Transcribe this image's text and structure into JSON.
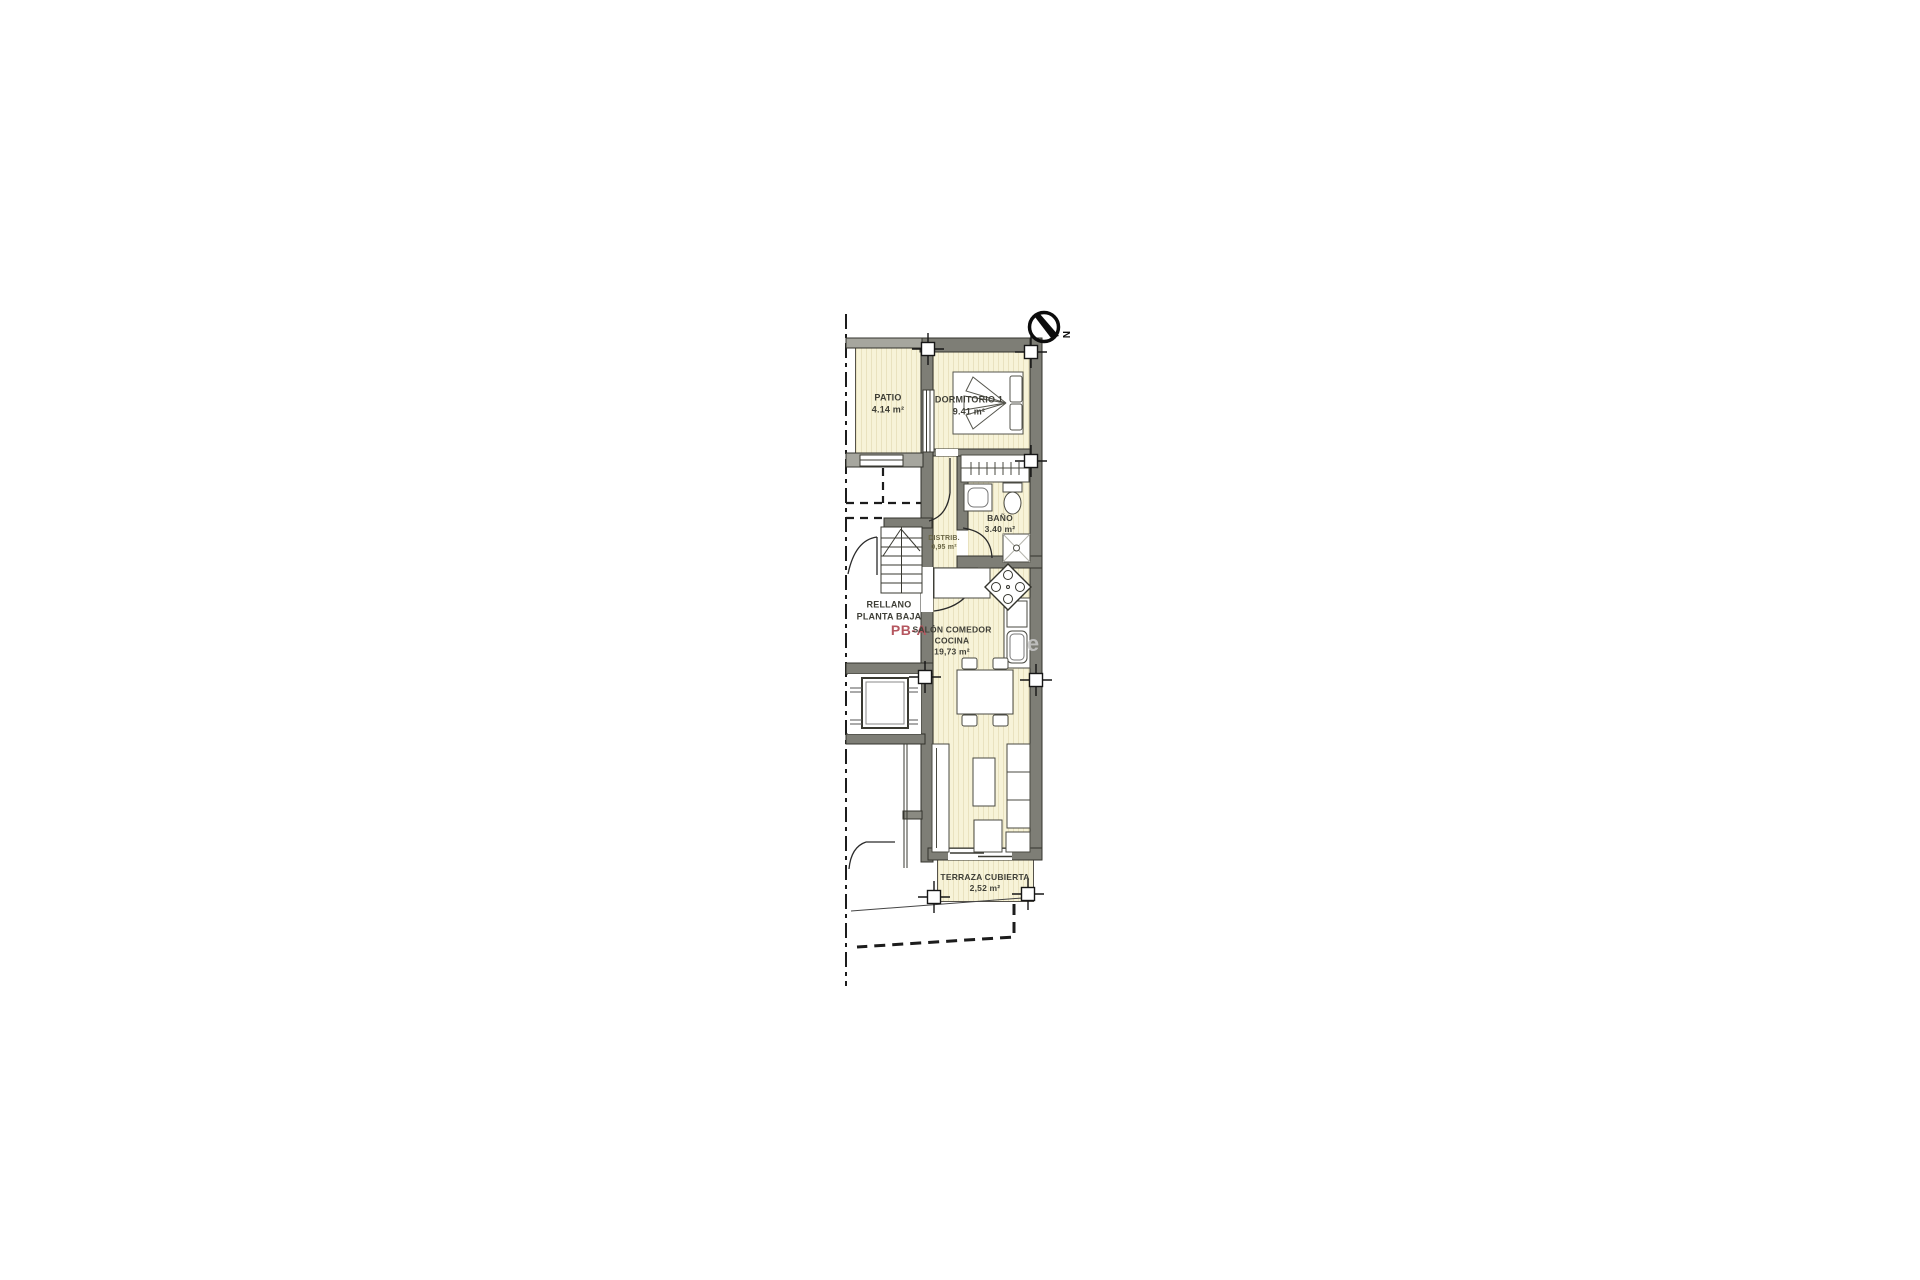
{
  "plan": {
    "unit_code": "PB-A",
    "compass_letter": "N",
    "watermark": "e",
    "rooms": {
      "patio": {
        "name": "PATIO",
        "area": "4.14 m²"
      },
      "dormitorio": {
        "name": "DORMITORIO 1",
        "area": "9.41 m²"
      },
      "bano": {
        "name": "BAÑO",
        "area": "3.40 m²"
      },
      "distribuidor": {
        "name": "DISTRIB.",
        "area": "0,95 m²"
      },
      "rellano": {
        "name": "RELLANO",
        "name2": "PLANTA BAJA"
      },
      "salon": {
        "name": "SALÓN COMEDOR",
        "name2": "COCINA",
        "area": "19,73 m²"
      },
      "terraza": {
        "name": "TERRAZA CUBIERTA",
        "area": "2,52 m²"
      }
    }
  }
}
